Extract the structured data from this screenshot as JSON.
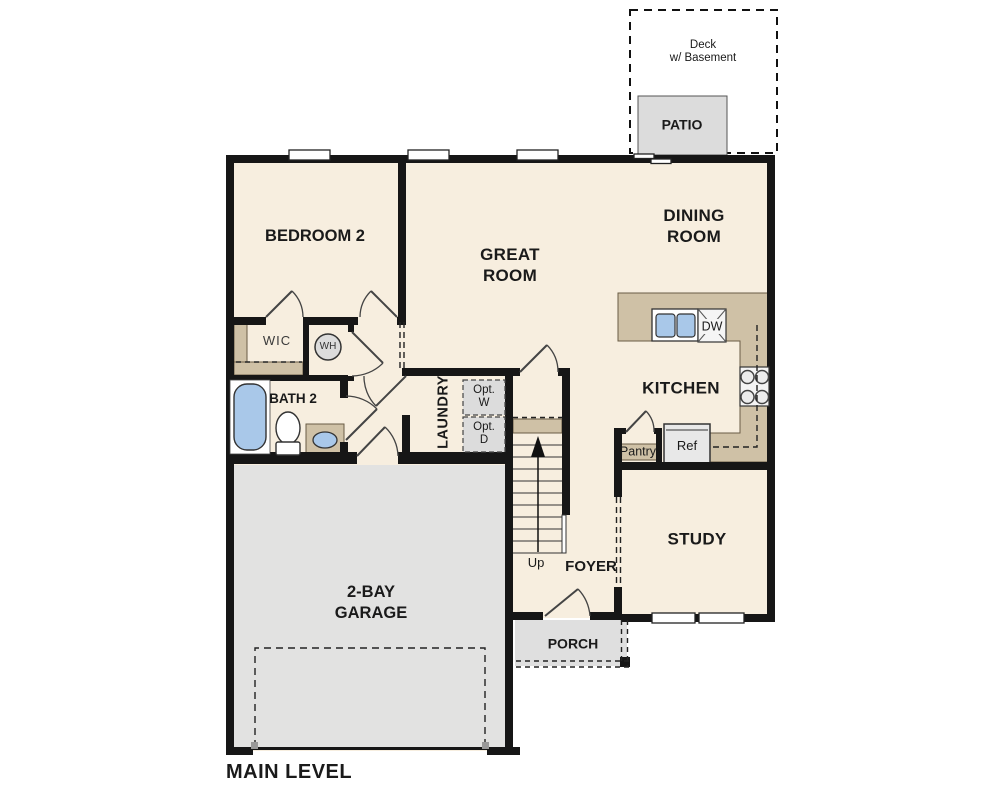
{
  "title": "MAIN LEVEL",
  "colors": {
    "floor_cream": "#f7eedf",
    "counter_tan": "#cfc1a6",
    "garage_gray": "#e2e2e1",
    "outdoor_gray": "#dcdcdc",
    "fixture_blue": "#a9c8e9",
    "wall_black": "#161616"
  },
  "outdoor": {
    "deck": {
      "line1": "Deck",
      "line2": "w/ Basement"
    },
    "patio": "PATIO",
    "porch": "PORCH"
  },
  "rooms": {
    "bedroom2": "BEDROOM 2",
    "great_room": {
      "line1": "GREAT",
      "line2": "ROOM"
    },
    "dining_room": {
      "line1": "DINING",
      "line2": "ROOM"
    },
    "kitchen": "KITCHEN",
    "study": "STUDY",
    "foyer": "FOYER",
    "garage": {
      "line1": "2-BAY",
      "line2": "GARAGE"
    },
    "laundry": "LAUNDRY",
    "bath2": "BATH 2",
    "wic": "WIC"
  },
  "fixtures": {
    "wh": "WH",
    "dw": "DW",
    "ref": "Ref",
    "pantry": "Pantry",
    "opt_washer": {
      "line1": "Opt.",
      "line2": "W"
    },
    "opt_dryer": {
      "line1": "Opt.",
      "line2": "D"
    },
    "stairs_up": "Up"
  }
}
